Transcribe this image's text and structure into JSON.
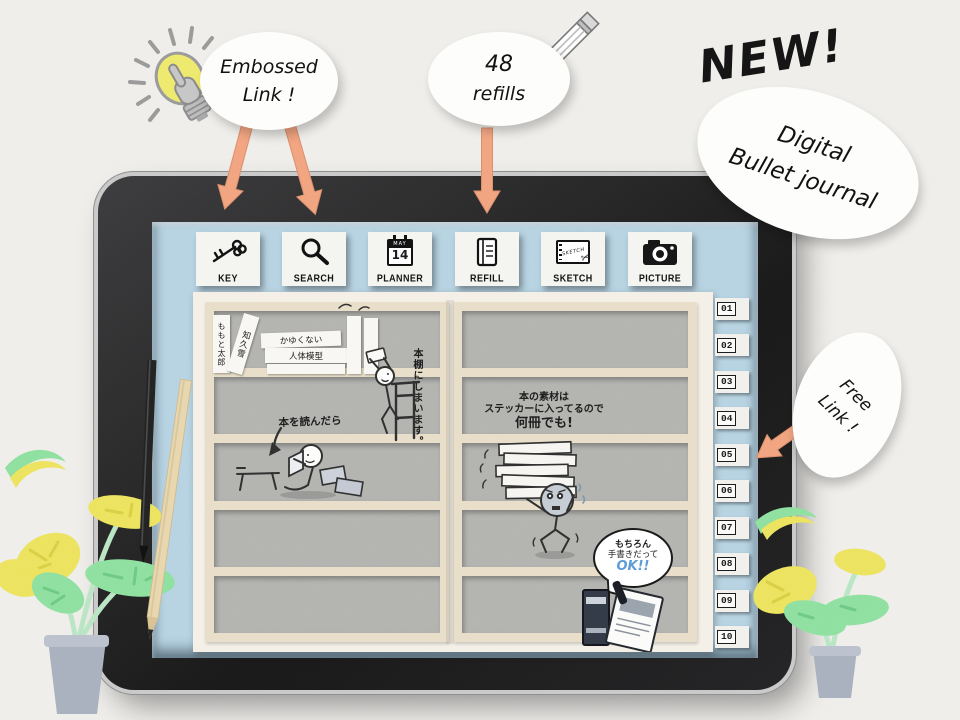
{
  "promo": {
    "new_label": "NEW!",
    "bubbles": {
      "embossed": {
        "lines": [
          "Embossed",
          "Link !"
        ]
      },
      "refills": {
        "lines": [
          "48",
          "refills"
        ]
      },
      "digital": {
        "lines": [
          "Digital",
          "Bullet journal"
        ]
      },
      "free": {
        "lines": [
          "Free",
          "Link !"
        ]
      }
    }
  },
  "toolbar": {
    "buttons": [
      {
        "label": "KEY"
      },
      {
        "label": "SEARCH"
      },
      {
        "label": "PLANNER",
        "calendar_month": "MAY",
        "calendar_day": "14"
      },
      {
        "label": "REFILL"
      },
      {
        "label": "SKETCH",
        "cover_text": "SKETCH"
      },
      {
        "label": "PICTURE"
      }
    ]
  },
  "index_tabs": [
    "01",
    "02",
    "03",
    "04",
    "05",
    "06",
    "07",
    "08",
    "09",
    "10"
  ],
  "shelf": {
    "left_page": {
      "book_spines": [
        "ももと太郎",
        "知久雪",
        "かゆくない",
        "人体模型"
      ],
      "caption_shelve": "本棚にしまいます。",
      "caption_read": "本を読んだら"
    },
    "right_page": {
      "caption_lines": [
        "本の素材は",
        "ステッカーに入ってるので",
        "何冊でも!"
      ],
      "speech": [
        "もちろん",
        "手書きだって",
        "OK!!"
      ]
    }
  },
  "colors": {
    "arrow_orange": "#f2a480",
    "screen_blue": "#b7d3e2",
    "shelf_frame_tan": "#e8dec9",
    "shelf_interior_gray": "#b3b3b0",
    "bulb_yellow": "#eeea6e",
    "leaf_yellow": "#ece35f",
    "leaf_green": "#8fe0a1",
    "ok_blue": "#5b9bd5"
  }
}
